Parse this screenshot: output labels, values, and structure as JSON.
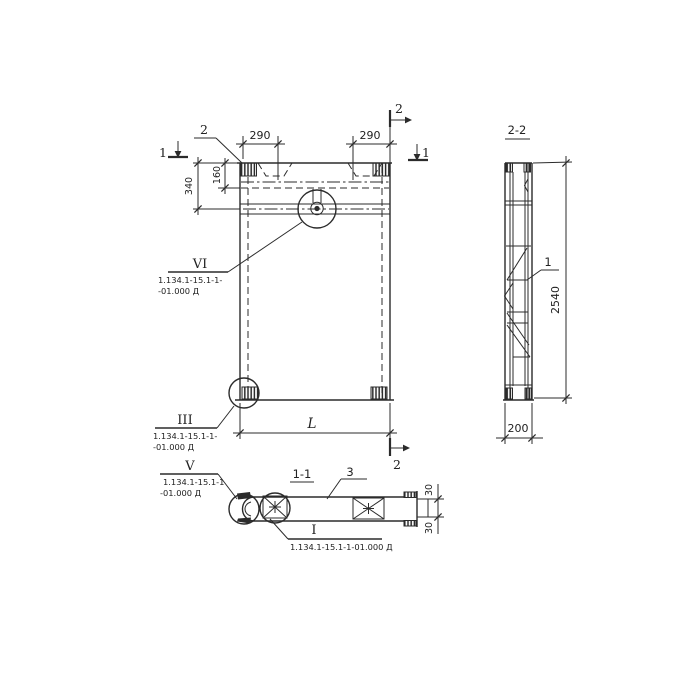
{
  "drawing": {
    "front_view": {
      "dim_290_left": "290",
      "dim_290_right": "290",
      "dim_340": "340",
      "dim_160": "160",
      "dim_length": "L",
      "cut1_left": "1",
      "cut1_right": "1",
      "cut2_top": "2",
      "cut2_bottom": "2",
      "corner_detail_ref": "2"
    },
    "side_view": {
      "title": "2-2",
      "part_label": "1",
      "dim_height": "2540",
      "dim_width": "200"
    },
    "section_view": {
      "title": "1-1",
      "part_label": "3",
      "dim_flange_top": "30",
      "dim_flange_bottom": "30"
    },
    "callouts": {
      "vi": {
        "num": "VI",
        "ref_line1": "1.134.1-15.1-1-",
        "ref_line2": "-01.000 Д"
      },
      "iii": {
        "num": "III",
        "ref_line1": "1.134.1-15.1-1-",
        "ref_line2": "-01.000 Д"
      },
      "v": {
        "num": "V",
        "ref_line1": "1.134.1-15.1-1",
        "ref_line2": "-01.000 Д"
      },
      "i": {
        "num": "I",
        "ref": "1.134.1-15.1-1-01.000 Д"
      }
    }
  }
}
